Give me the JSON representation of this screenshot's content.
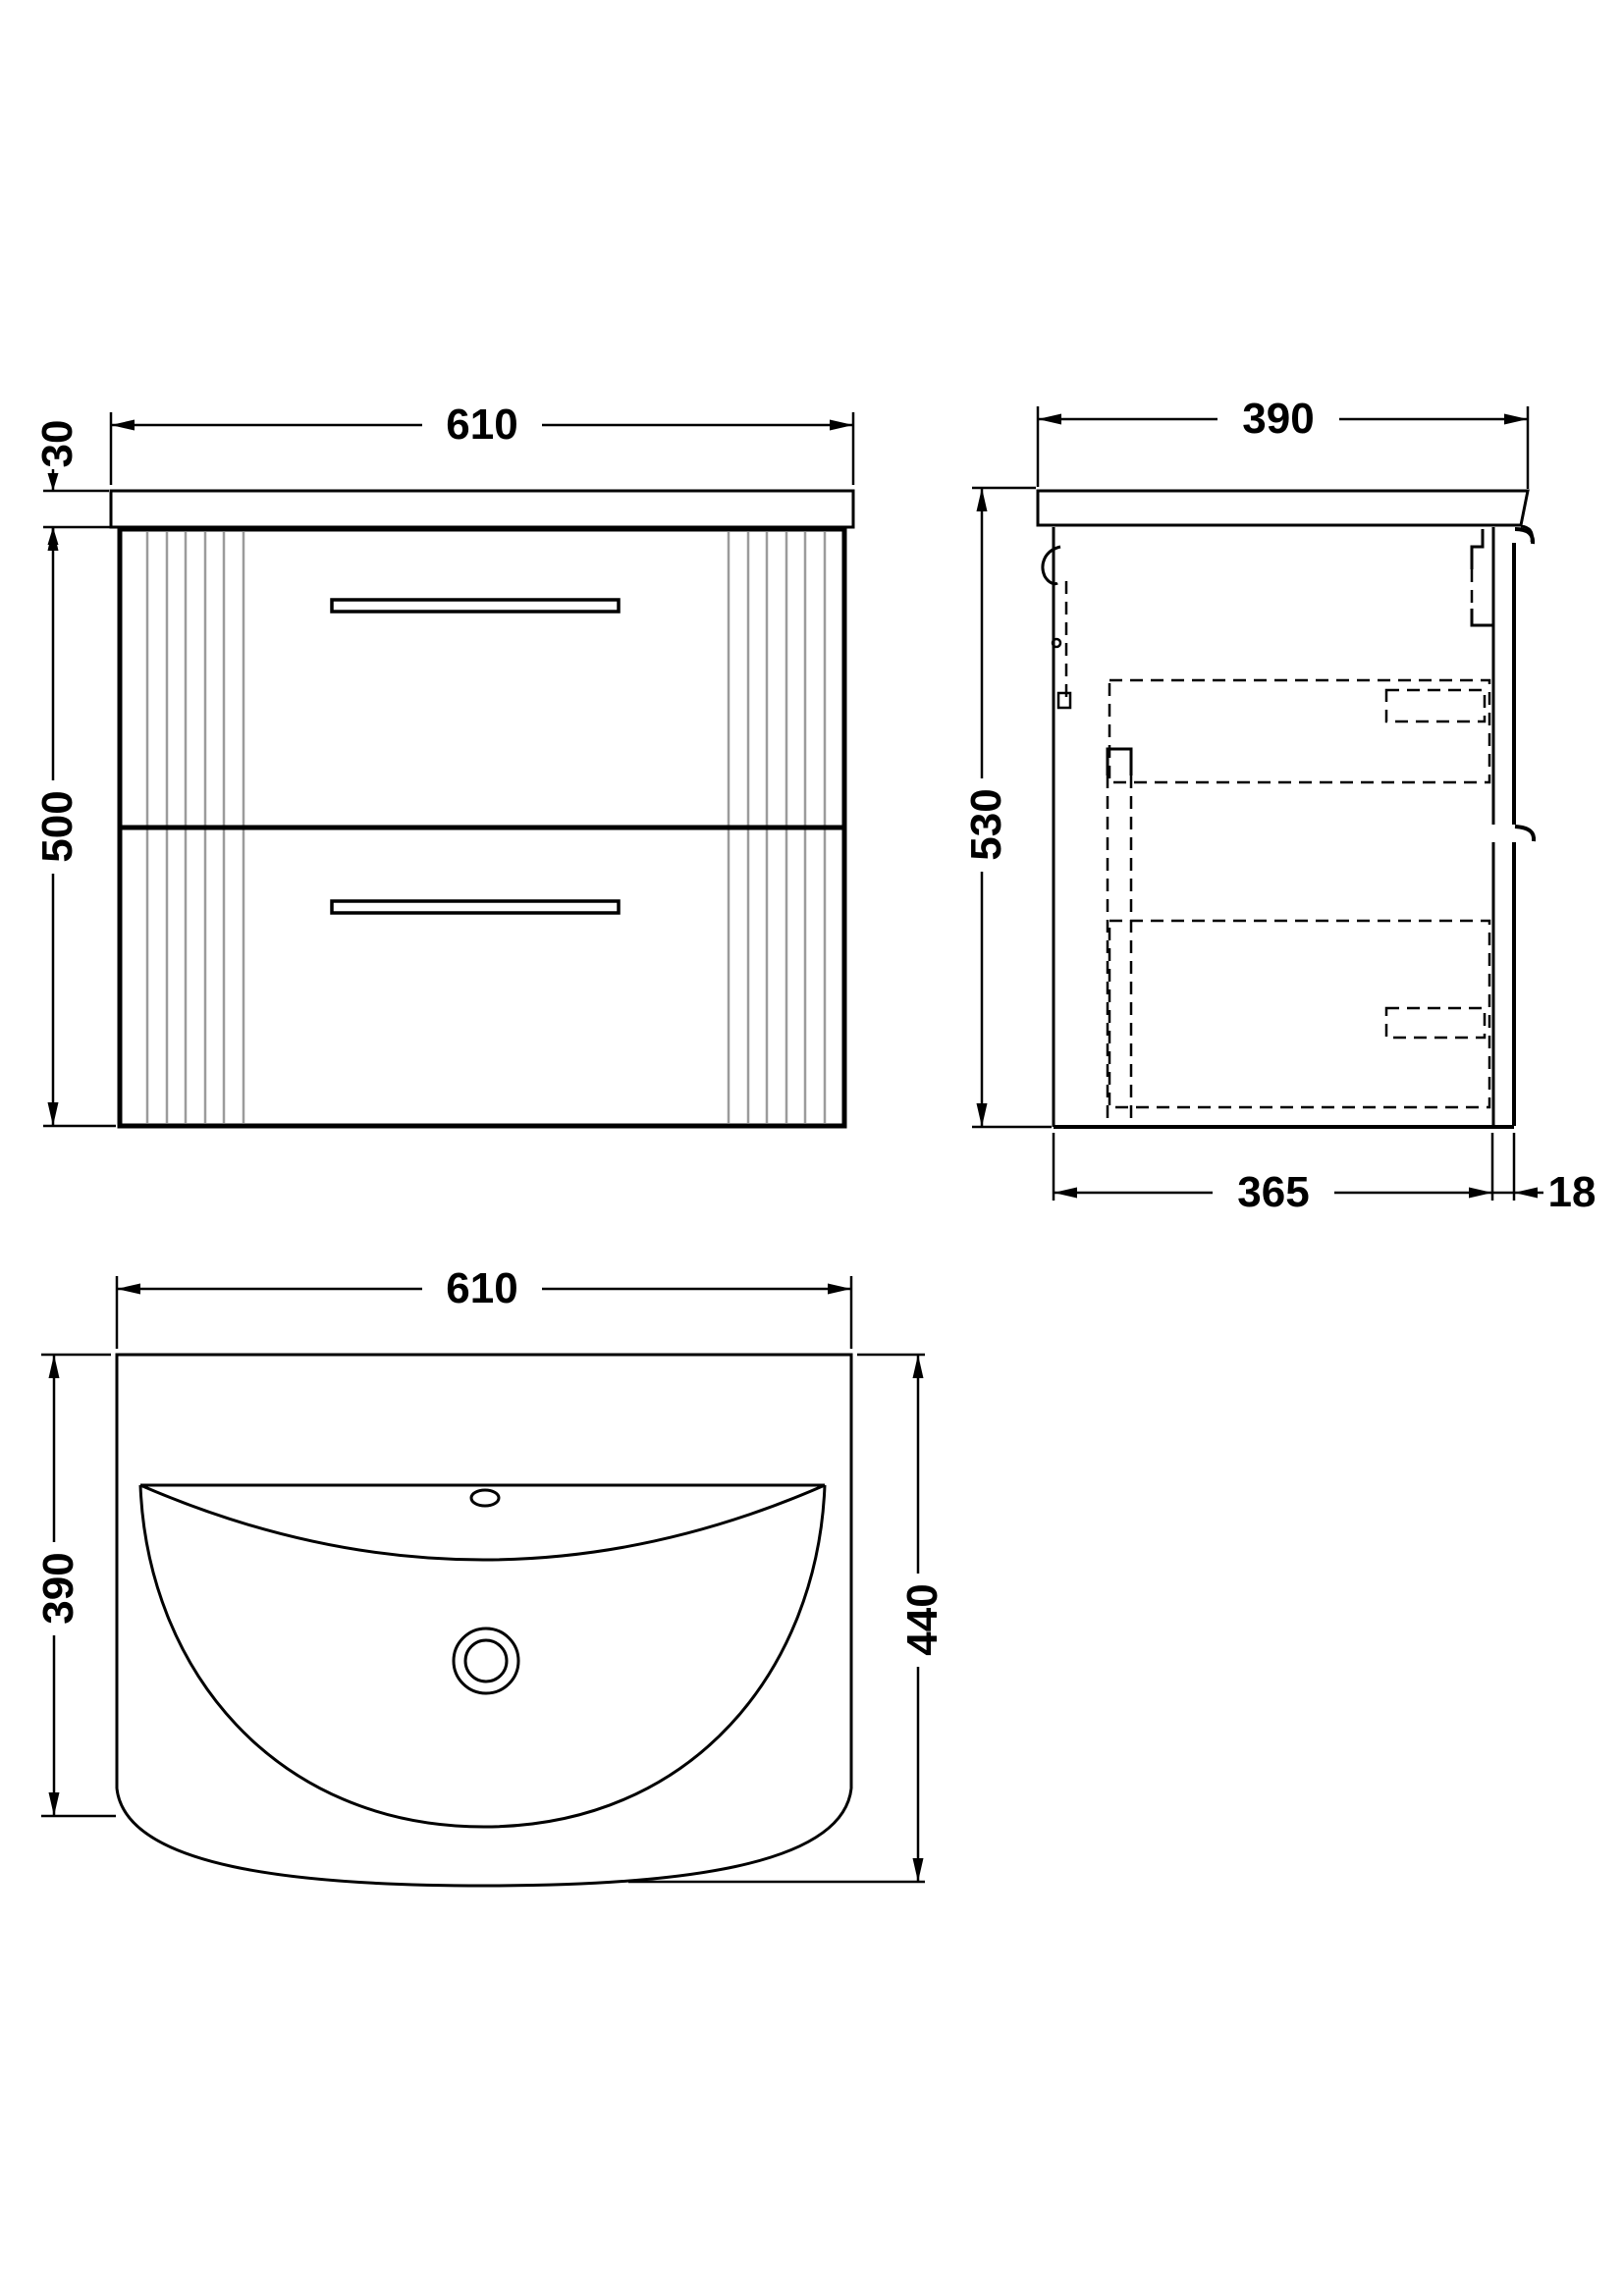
{
  "views": {
    "front": {
      "width": "610",
      "worktop_thickness": "30",
      "cabinet_height": "500"
    },
    "side": {
      "depth": "390",
      "height": "530",
      "cabinet_depth": "365",
      "front_panel_thickness": "18"
    },
    "plan": {
      "width": "610",
      "basin_depth": "390",
      "overall_depth": "440"
    }
  },
  "style": {
    "line_color": "#000000",
    "flute_color": "#9b9b9b",
    "background": "#ffffff"
  }
}
